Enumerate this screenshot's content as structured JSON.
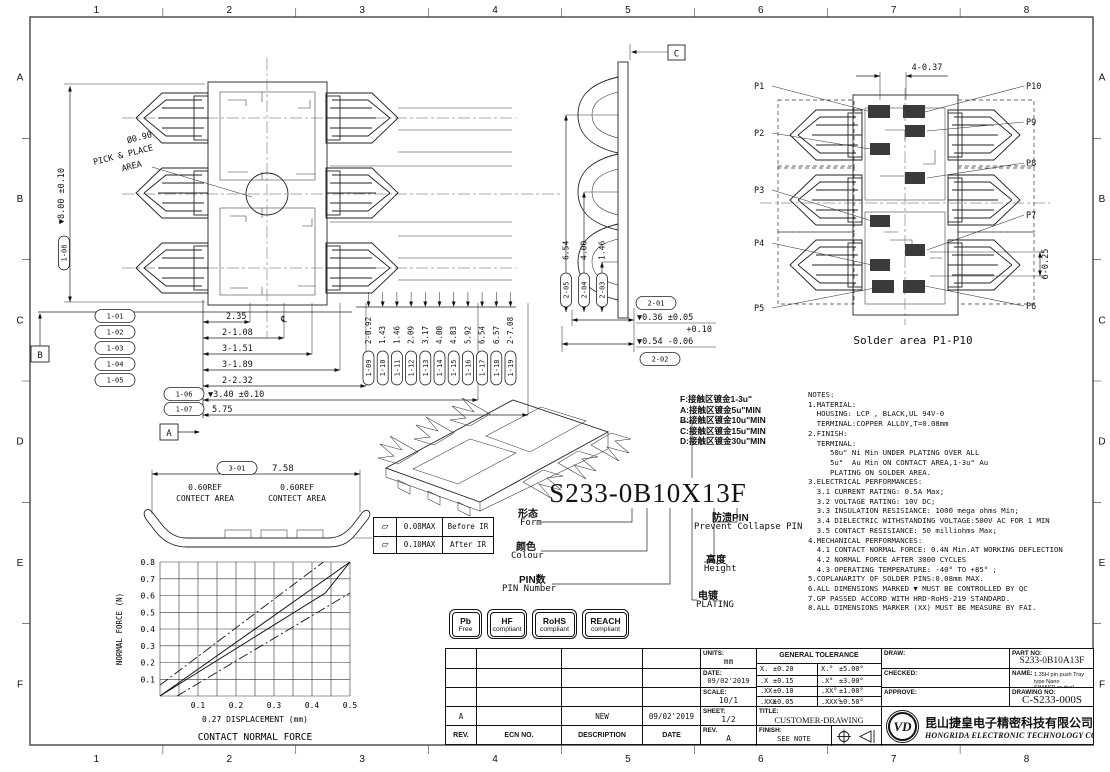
{
  "frame": {
    "col_labels": [
      "1",
      "2",
      "3",
      "4",
      "5",
      "6",
      "7",
      "8"
    ],
    "row_labels": [
      "A",
      "B",
      "C",
      "D",
      "E",
      "F"
    ]
  },
  "top_view": {
    "pick_place_dia": "Ø0.90",
    "pick_place_line1": "PICK & PLACE",
    "pick_place_line2": "AREA",
    "height_dim": {
      "id": "1-08",
      "value": "▼8.00 ±0.10"
    },
    "datum_a": "A",
    "datum_b": "B",
    "centerline_mark": "℄",
    "h_dims": [
      {
        "id": "1-01",
        "value": "2.35"
      },
      {
        "id": "1-02",
        "value": "2-1.08"
      },
      {
        "id": "1-03",
        "value": "3-1.51"
      },
      {
        "id": "1-04",
        "value": "3-1.89"
      },
      {
        "id": "1-05",
        "value": "2-2.32"
      },
      {
        "id": "1-06",
        "value": "▼3.40 ±0.10"
      },
      {
        "id": "1-07",
        "value": "5.75"
      }
    ],
    "v_dims": [
      {
        "id": "1-09",
        "value": "2-0.92"
      },
      {
        "id": "1-10",
        "value": "1.43"
      },
      {
        "id": "1-11",
        "value": "1.46"
      },
      {
        "id": "1-12",
        "value": "2.09"
      },
      {
        "id": "1-13",
        "value": "3.17"
      },
      {
        "id": "1-14",
        "value": "4.00"
      },
      {
        "id": "1-15",
        "value": "4.83"
      },
      {
        "id": "1-16",
        "value": "5.92"
      },
      {
        "id": "1-17",
        "value": "6.54"
      },
      {
        "id": "1-18",
        "value": "6.57"
      },
      {
        "id": "1-19",
        "value": "2-7.08"
      }
    ]
  },
  "section_view": {
    "datum_c": "C",
    "side_dims": [
      {
        "id": "2-05",
        "value": "6.54"
      },
      {
        "id": "2-04",
        "value": "4.00"
      },
      {
        "id": "2-03",
        "value": "1.46"
      }
    ],
    "bottom_dims": [
      {
        "id": "2-01",
        "value": "▼0.36 ±0.05"
      },
      {
        "id": "2-02",
        "value": "▼0.54",
        "tol_top": "+0.10",
        "tol_bottom": "-0.06"
      }
    ]
  },
  "solder_view": {
    "top_dim": "4-0.37",
    "right_dim": "6-0.25",
    "caption": "Solder area P1-P10",
    "pins_left": [
      "P1",
      "P2",
      "P3",
      "P4",
      "P5"
    ],
    "pins_right": [
      "P10",
      "P9",
      "P8",
      "P7",
      "P6"
    ]
  },
  "profile_view": {
    "dim": {
      "id": "3-01",
      "value": "7.58"
    },
    "contact_area_line1": "0.60REF",
    "contact_area_line2": "CONTECT AREA"
  },
  "flatness_table": {
    "rows": [
      {
        "symbol": "▱",
        "value": "0.08MAX",
        "label": "Before IR"
      },
      {
        "symbol": "▱",
        "value": "0.10MAX",
        "label": "After IR"
      }
    ]
  },
  "part_number": {
    "value": "S233-0B10X13F",
    "form_zh": "形态",
    "form_en": "Form",
    "colour_zh": "颜色",
    "colour_en": "Colour",
    "pin_zh": "PIN数",
    "pin_en": "PIN Number",
    "collapse_zh": "防溃PIN",
    "collapse_en": "Prevent Collapse PIN",
    "height_zh": "高度",
    "height_en": "Height",
    "plating_zh": "电镀",
    "plating_en": "PLATING",
    "plating_options": [
      "F:接触区镀金1-3u\"",
      "A:接触区镀金5u\"MIN",
      "B:接触区镀金10u\"MIN",
      "C:接触区镀金15u\"MIN",
      "D:接触区镀金30u\"MIN"
    ]
  },
  "notes": {
    "lines": [
      "NOTES:",
      "1.MATERIAL:",
      "  HOUSING: LCP , BLACK,UL 94V-0",
      "  TERMINAL:COPPER ALLOY,T=0.08mm",
      "2.FINISH:",
      "  TERMINAL:",
      "     50u\" Ni Min UNDER PLATING OVER ALL",
      "     5u\"  Au Min ON CONTACT AREA,1-3u\" Au",
      "     PLATING ON SOLDER AREA.",
      "3.ELECTRICAL PERFORMANCES:",
      "  3.1 CURRENT RATING: 0.5A Max;",
      "  3.2 VOLTAGE RATING: 10V DC;",
      "  3.3 INSULATION RESISIANCE: 1000 mega ohms Min;",
      "  3.4 DIELECTRIC WITHSTANDING VOLTAGE:500V AC FOR 1 MIN",
      "  3.5 CONTACT RESISIANCE: 50 milliohms Max;",
      "4.MECHANICAL PERFORMANCES:",
      "  4.1 CONTACT NORMAL FORCE: 0.4N Min.AT WORKING DEFLECTION",
      "  4.2 NORMAL FORCE AFTER 3000 CYCLES",
      "  4.3 OPERATING TEMPERATURE: -40° TO +85° ;",
      "5.COPLANARITY OF SOLDER PINS:0.08mm MAX.",
      "6.ALL DIMENSIONS MARKED ▼ MUST BE CONTROLLED BY QC",
      "7.GP PASSED ACCORD WITH HRD-RoHS-219 STANDARD.",
      "8.ALL DIMENSIONS MARKER (XX) MUST BE MEASURE BY FAI."
    ]
  },
  "badges": [
    {
      "top": "Pb",
      "bottom": "Free"
    },
    {
      "top": "HF",
      "bottom": "compliant"
    },
    {
      "top": "RoHS",
      "bottom": "compliant"
    },
    {
      "top": "REACH",
      "bottom": "compliant"
    }
  ],
  "revision_table": {
    "headers": [
      "REV.",
      "ECN NO.",
      "DESCRIPTION",
      "DATE"
    ],
    "rows": [
      [
        "",
        "",
        "",
        ""
      ],
      [
        "",
        "",
        "",
        ""
      ],
      [
        "",
        "",
        "",
        ""
      ],
      [
        "A",
        "",
        "NEW",
        "09/02'2019"
      ]
    ]
  },
  "title_block": {
    "units_label": "UNITS:",
    "units_value": "mm",
    "date_label": "DATE:",
    "date_value": "09/02'2019",
    "scale_label": "SCALE:",
    "scale_value": "10/1",
    "sheet_label": "SHEET:",
    "sheet_value": "1/2",
    "rev_label": "REV.",
    "rev_value": "A",
    "tol_title": "GENERAL TOLERANCE",
    "tolerances": [
      {
        "dim": "X.",
        "dim_tol": "±0.20",
        "ang": "X.°",
        "ang_tol": "±5.00°"
      },
      {
        "dim": ".X",
        "dim_tol": "±0.15",
        "ang": ".X°",
        "ang_tol": "±3.00°"
      },
      {
        "dim": ".XX",
        "dim_tol": "±0.10",
        "ang": ".XX°",
        "ang_tol": "±1.00°"
      },
      {
        "dim": ".XXX",
        "dim_tol": "±0.05",
        "ang": ".XXX°",
        "ang_tol": "±0.50°"
      }
    ],
    "title_label": "TITLE:",
    "title_value": "CUSTOMER-DRAWING",
    "finish_label": "FINISH:",
    "finish_value": "SEE NOTE",
    "draw_label": "DRAW:",
    "checked_label": "CHECKED:",
    "approve_label": "APPROVE:",
    "part_no_label": "PART NO:",
    "part_no_value": "S233-0B10A13F",
    "name_label": "NAME:",
    "name_line1": "1.35H pin push Tray type Nano",
    "name_line2": "SIM&SD or dual NanoSIM conn.",
    "drawing_no_label": "DRAWING NO:",
    "drawing_no_value": "C-S233-000S",
    "logo_text": "VD",
    "company_cn": "昆山捷皇电子精密科技有限公司",
    "company_en": "HONGRIDA ELECTRONIC TECHNOLOGY CO,LTD."
  },
  "chart_data": {
    "type": "line",
    "title": "CONTACT NORMAL FORCE",
    "xlabel": "0.27 DISPLACEMENT (mm)",
    "ylabel": "NORMAL FORCE (N)",
    "xlim": [
      0,
      0.5
    ],
    "ylim": [
      0,
      0.8
    ],
    "x_ticks": [
      0.1,
      0.2,
      0.3,
      0.4,
      0.5
    ],
    "y_ticks": [
      0.1,
      0.2,
      0.3,
      0.4,
      0.5,
      0.6,
      0.7,
      0.8
    ],
    "x_grid_step": 0.05,
    "y_grid_step": 0.1,
    "grid": true,
    "legend": "none",
    "series": [
      {
        "name": "upper tolerance limit",
        "style": "dashdot",
        "points": [
          [
            0,
            0.065
          ],
          [
            0.43,
            0.8
          ]
        ]
      },
      {
        "name": "nominal force",
        "style": "solid",
        "points": [
          [
            0,
            0
          ],
          [
            0.5,
            0.8
          ]
        ]
      },
      {
        "name": "nominal force lower",
        "style": "solid",
        "points": [
          [
            0,
            0
          ],
          [
            0.435,
            0.615
          ],
          [
            0.5,
            0.8
          ]
        ]
      },
      {
        "name": "lower tolerance limit",
        "style": "dashdot",
        "points": [
          [
            0.045,
            0
          ],
          [
            0.5,
            0.615
          ]
        ]
      }
    ]
  }
}
